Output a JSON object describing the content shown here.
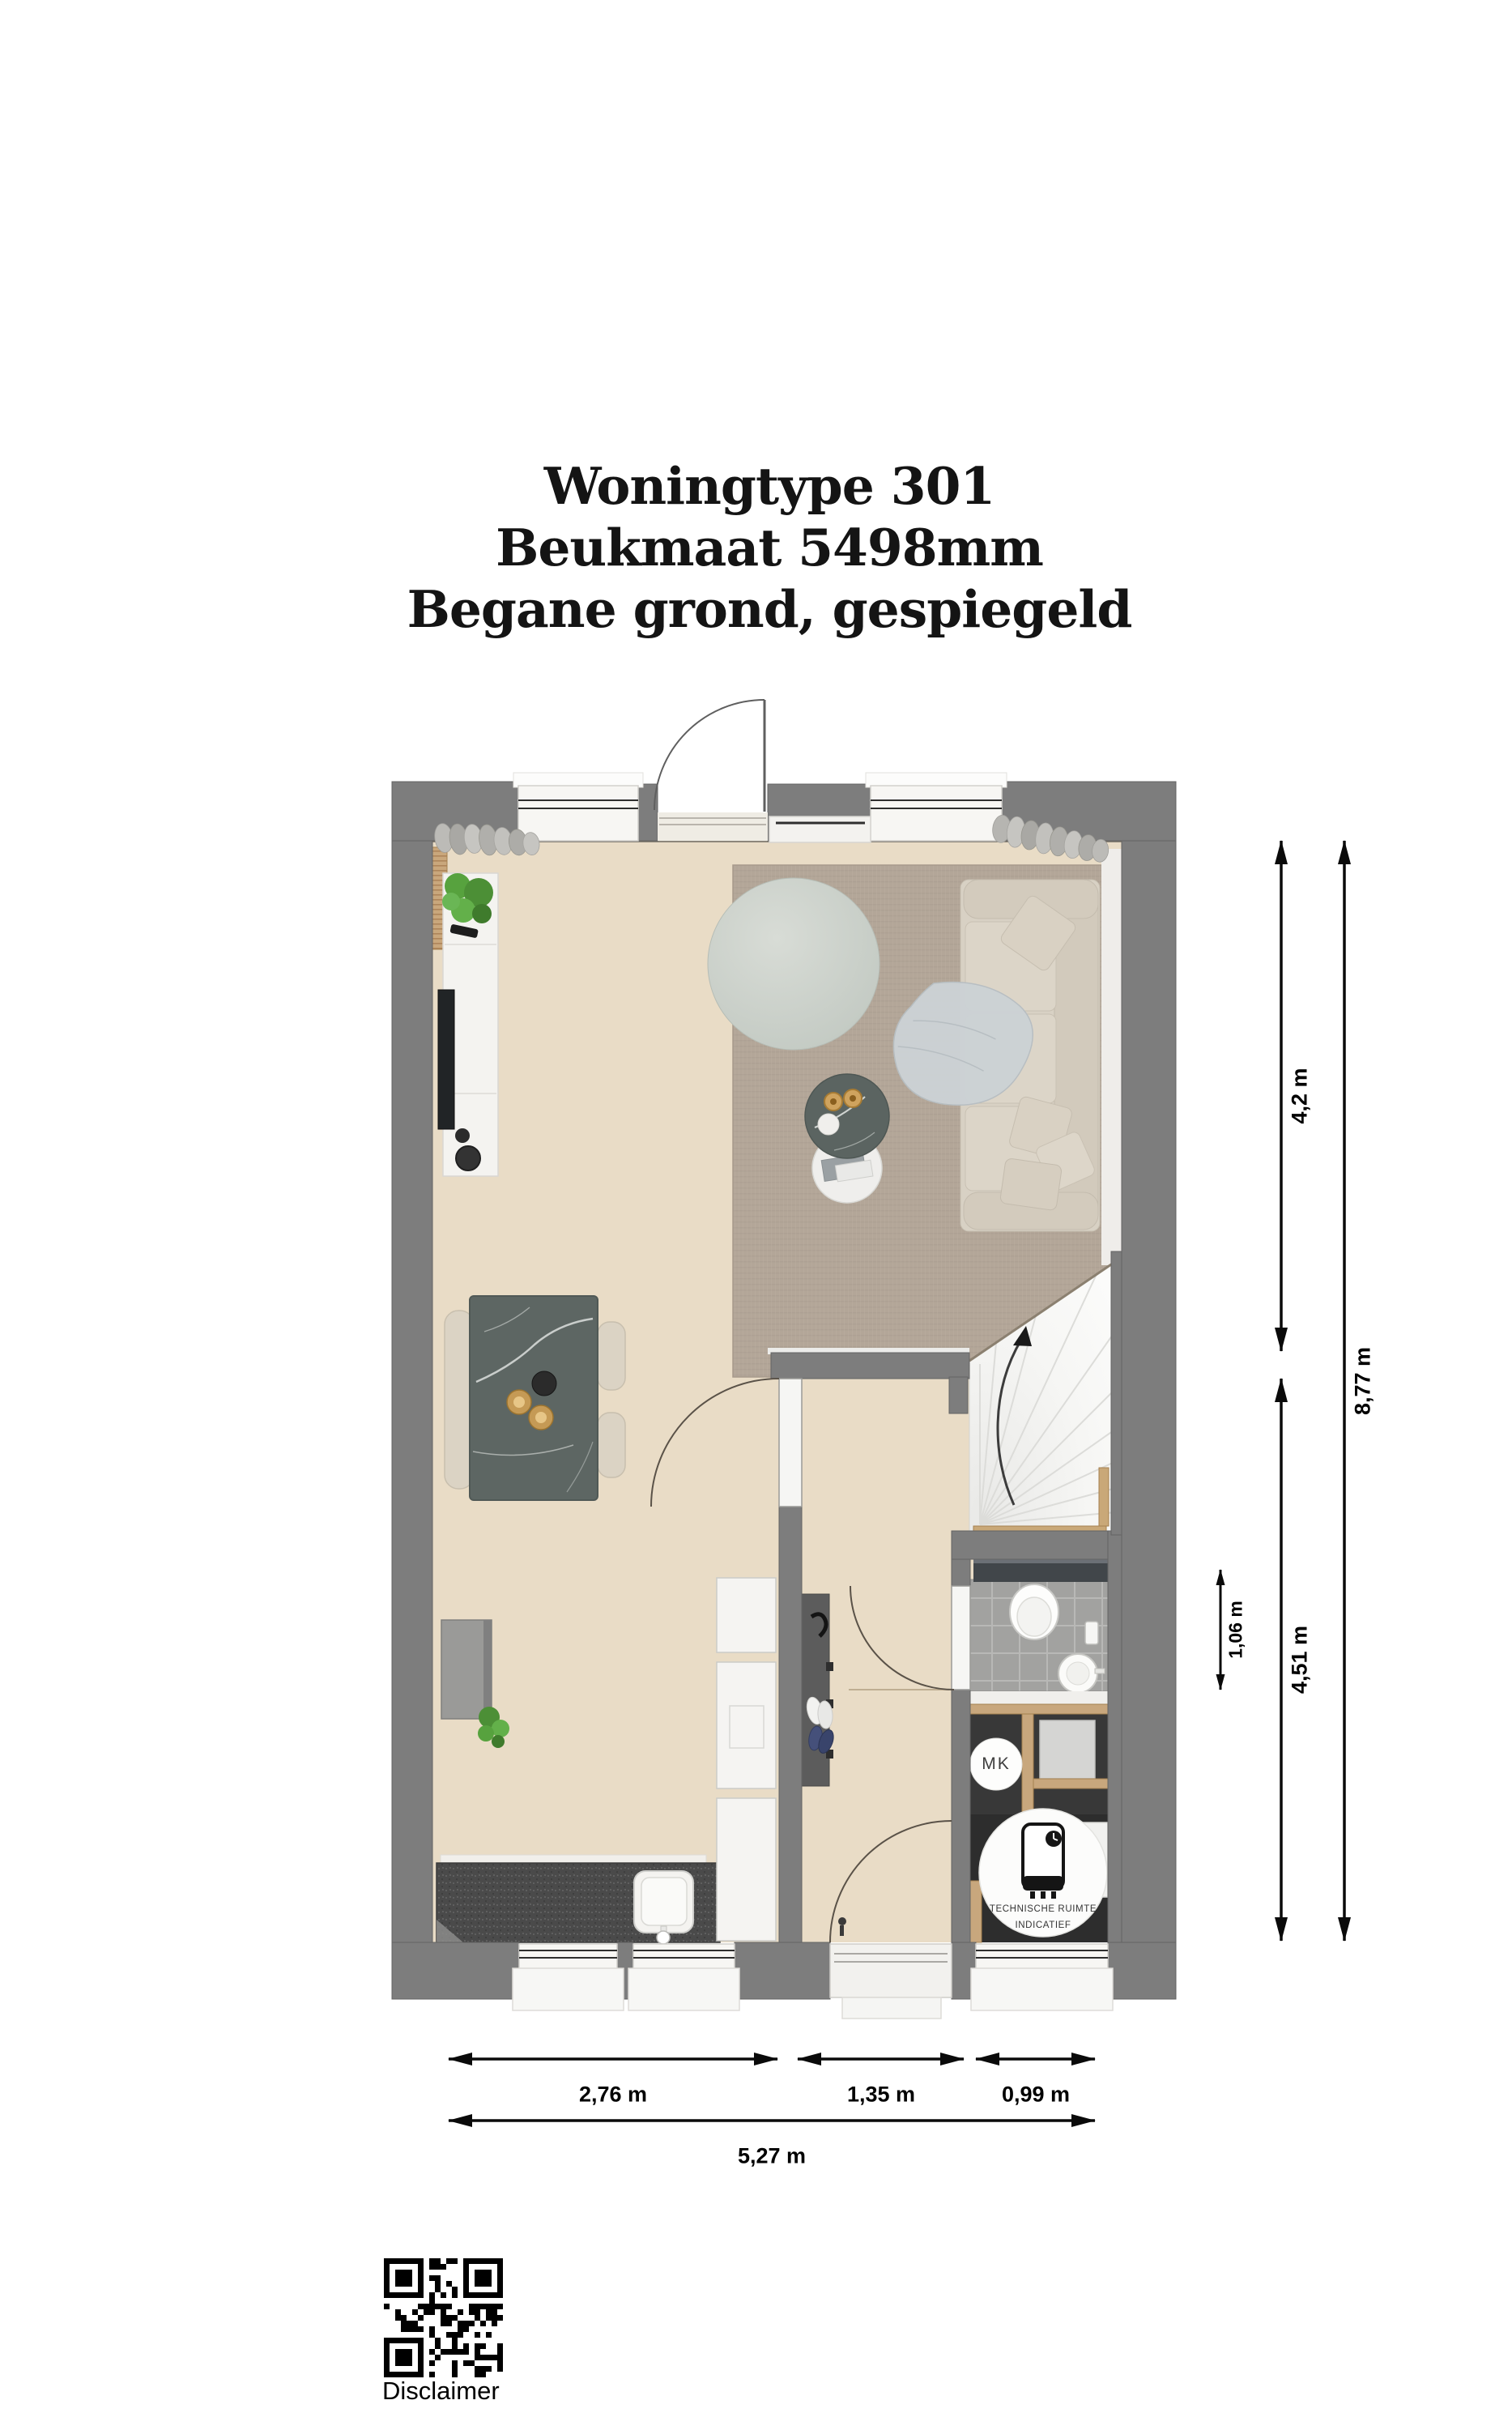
{
  "title": {
    "line1": "Woningtype 301",
    "line2": "Beukmaat 5498mm",
    "line3": "Begane grond, gespiegeld"
  },
  "dimensions": {
    "height_segments": [
      {
        "label": "4,2 m",
        "meaning": "living room depth"
      },
      {
        "label": "4,51 m",
        "meaning": "rear zone depth"
      }
    ],
    "height_total": {
      "label": "8,77 m"
    },
    "toilet_depth": {
      "label": "1,06 m"
    },
    "width_segments": [
      {
        "label": "2,76 m"
      },
      {
        "label": "1,35 m"
      },
      {
        "label": "0,99 m"
      }
    ],
    "width_total": {
      "label": "5,27 m"
    }
  },
  "labels": {
    "meter_cupboard": "MK",
    "technical_room_line1": "TECHNISCHE RUIMTE",
    "technical_room_line2": "INDICATIEF",
    "disclaimer": "Disclaimer"
  },
  "colors": {
    "wall": "#7d7d7d",
    "floor": "#e9dcc6",
    "rug": "#b3a698",
    "pouf": "#ccd2cc",
    "sofa": "#d8d1c4",
    "table_marble": "#5d6663",
    "kitchen_counter": "#4a4a4a",
    "toilet_tiles": "#a2a2a0",
    "wood_partition": "#c8a77d",
    "technical_floor": "#2d2d2d",
    "dimension_lines": "#0a0a0a"
  }
}
